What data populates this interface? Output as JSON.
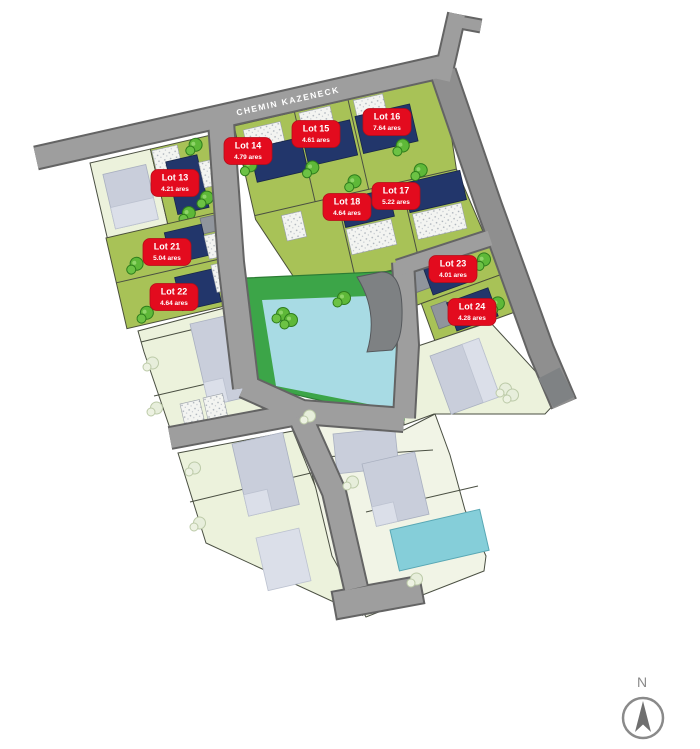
{
  "street": {
    "label": "CHEMIN KAZENECK"
  },
  "compass": {
    "north_label": "N"
  },
  "lots": [
    {
      "id": "lot-13",
      "name": "Lot 13",
      "area": "4.21 ares"
    },
    {
      "id": "lot-14",
      "name": "Lot 14",
      "area": "4.79 ares"
    },
    {
      "id": "lot-15",
      "name": "Lot 15",
      "area": "4.61 ares"
    },
    {
      "id": "lot-16",
      "name": "Lot 16",
      "area": "7.64 ares"
    },
    {
      "id": "lot-17",
      "name": "Lot 17",
      "area": "5.22 ares"
    },
    {
      "id": "lot-18",
      "name": "Lot 18",
      "area": "4.64 ares"
    },
    {
      "id": "lot-21",
      "name": "Lot 21",
      "area": "5.04 ares"
    },
    {
      "id": "lot-22",
      "name": "Lot 22",
      "area": "4.64 ares"
    },
    {
      "id": "lot-23",
      "name": "Lot 23",
      "area": "4.01 ares"
    },
    {
      "id": "lot-24",
      "name": "Lot 24",
      "area": "4.28 ares"
    }
  ],
  "colors": {
    "badge_red": "#e30b1e",
    "new_house_navy": "#22366b",
    "buildable_lot_green": "#a8c257",
    "public_green": "#3ca548",
    "water_teal": "#a8dbe4",
    "road_gray": "#9e9e9e",
    "existing_house_gray": "#c9cedb",
    "existing_parcel_pale": "#ecf2dc"
  }
}
